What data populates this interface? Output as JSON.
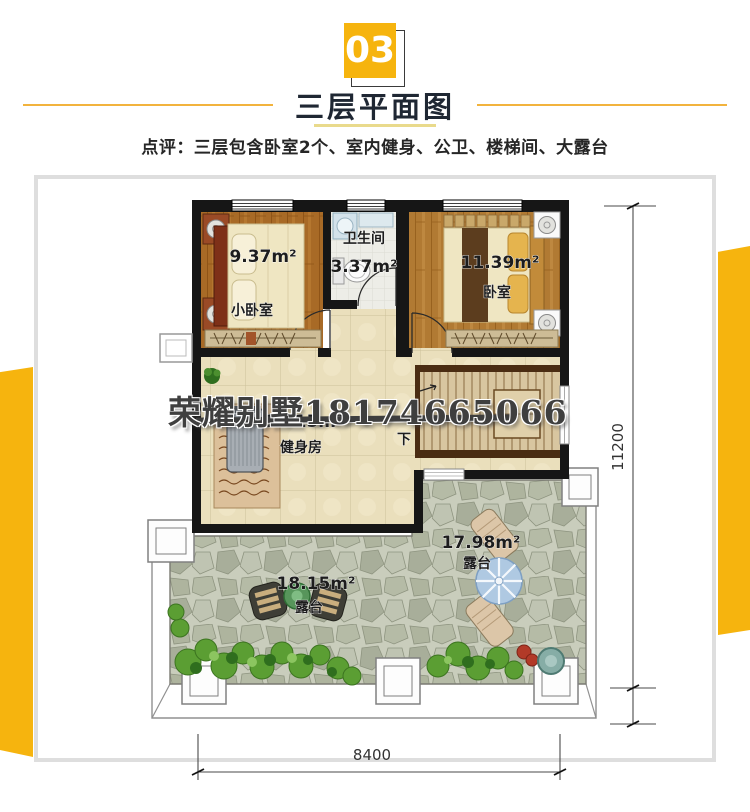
{
  "header": {
    "badge_number": "03",
    "title": "三层平面图",
    "comment": "点评：三层包含卧室2个、室内健身、公卫、楼梯间、大露台"
  },
  "watermark": {
    "text": "荣耀别墅18174665066"
  },
  "plan": {
    "rooms": [
      {
        "name": "小卧室",
        "area": "9.37m²"
      },
      {
        "name": "卫生间",
        "area": "3.37m²"
      },
      {
        "name": "卧室",
        "area": "11.39m²"
      },
      {
        "name": "健身房",
        "area": "17.15m²"
      },
      {
        "name": "露台",
        "area": "17.98m²"
      },
      {
        "name": "露台",
        "area": "18.15m²"
      }
    ],
    "stair_down_label": "下",
    "dimensions": {
      "horizontal": "8400",
      "vertical": "11200"
    }
  },
  "colors": {
    "accent_yellow": "#F6B40E",
    "title_text": "#1F2733",
    "wall": "#161616"
  }
}
